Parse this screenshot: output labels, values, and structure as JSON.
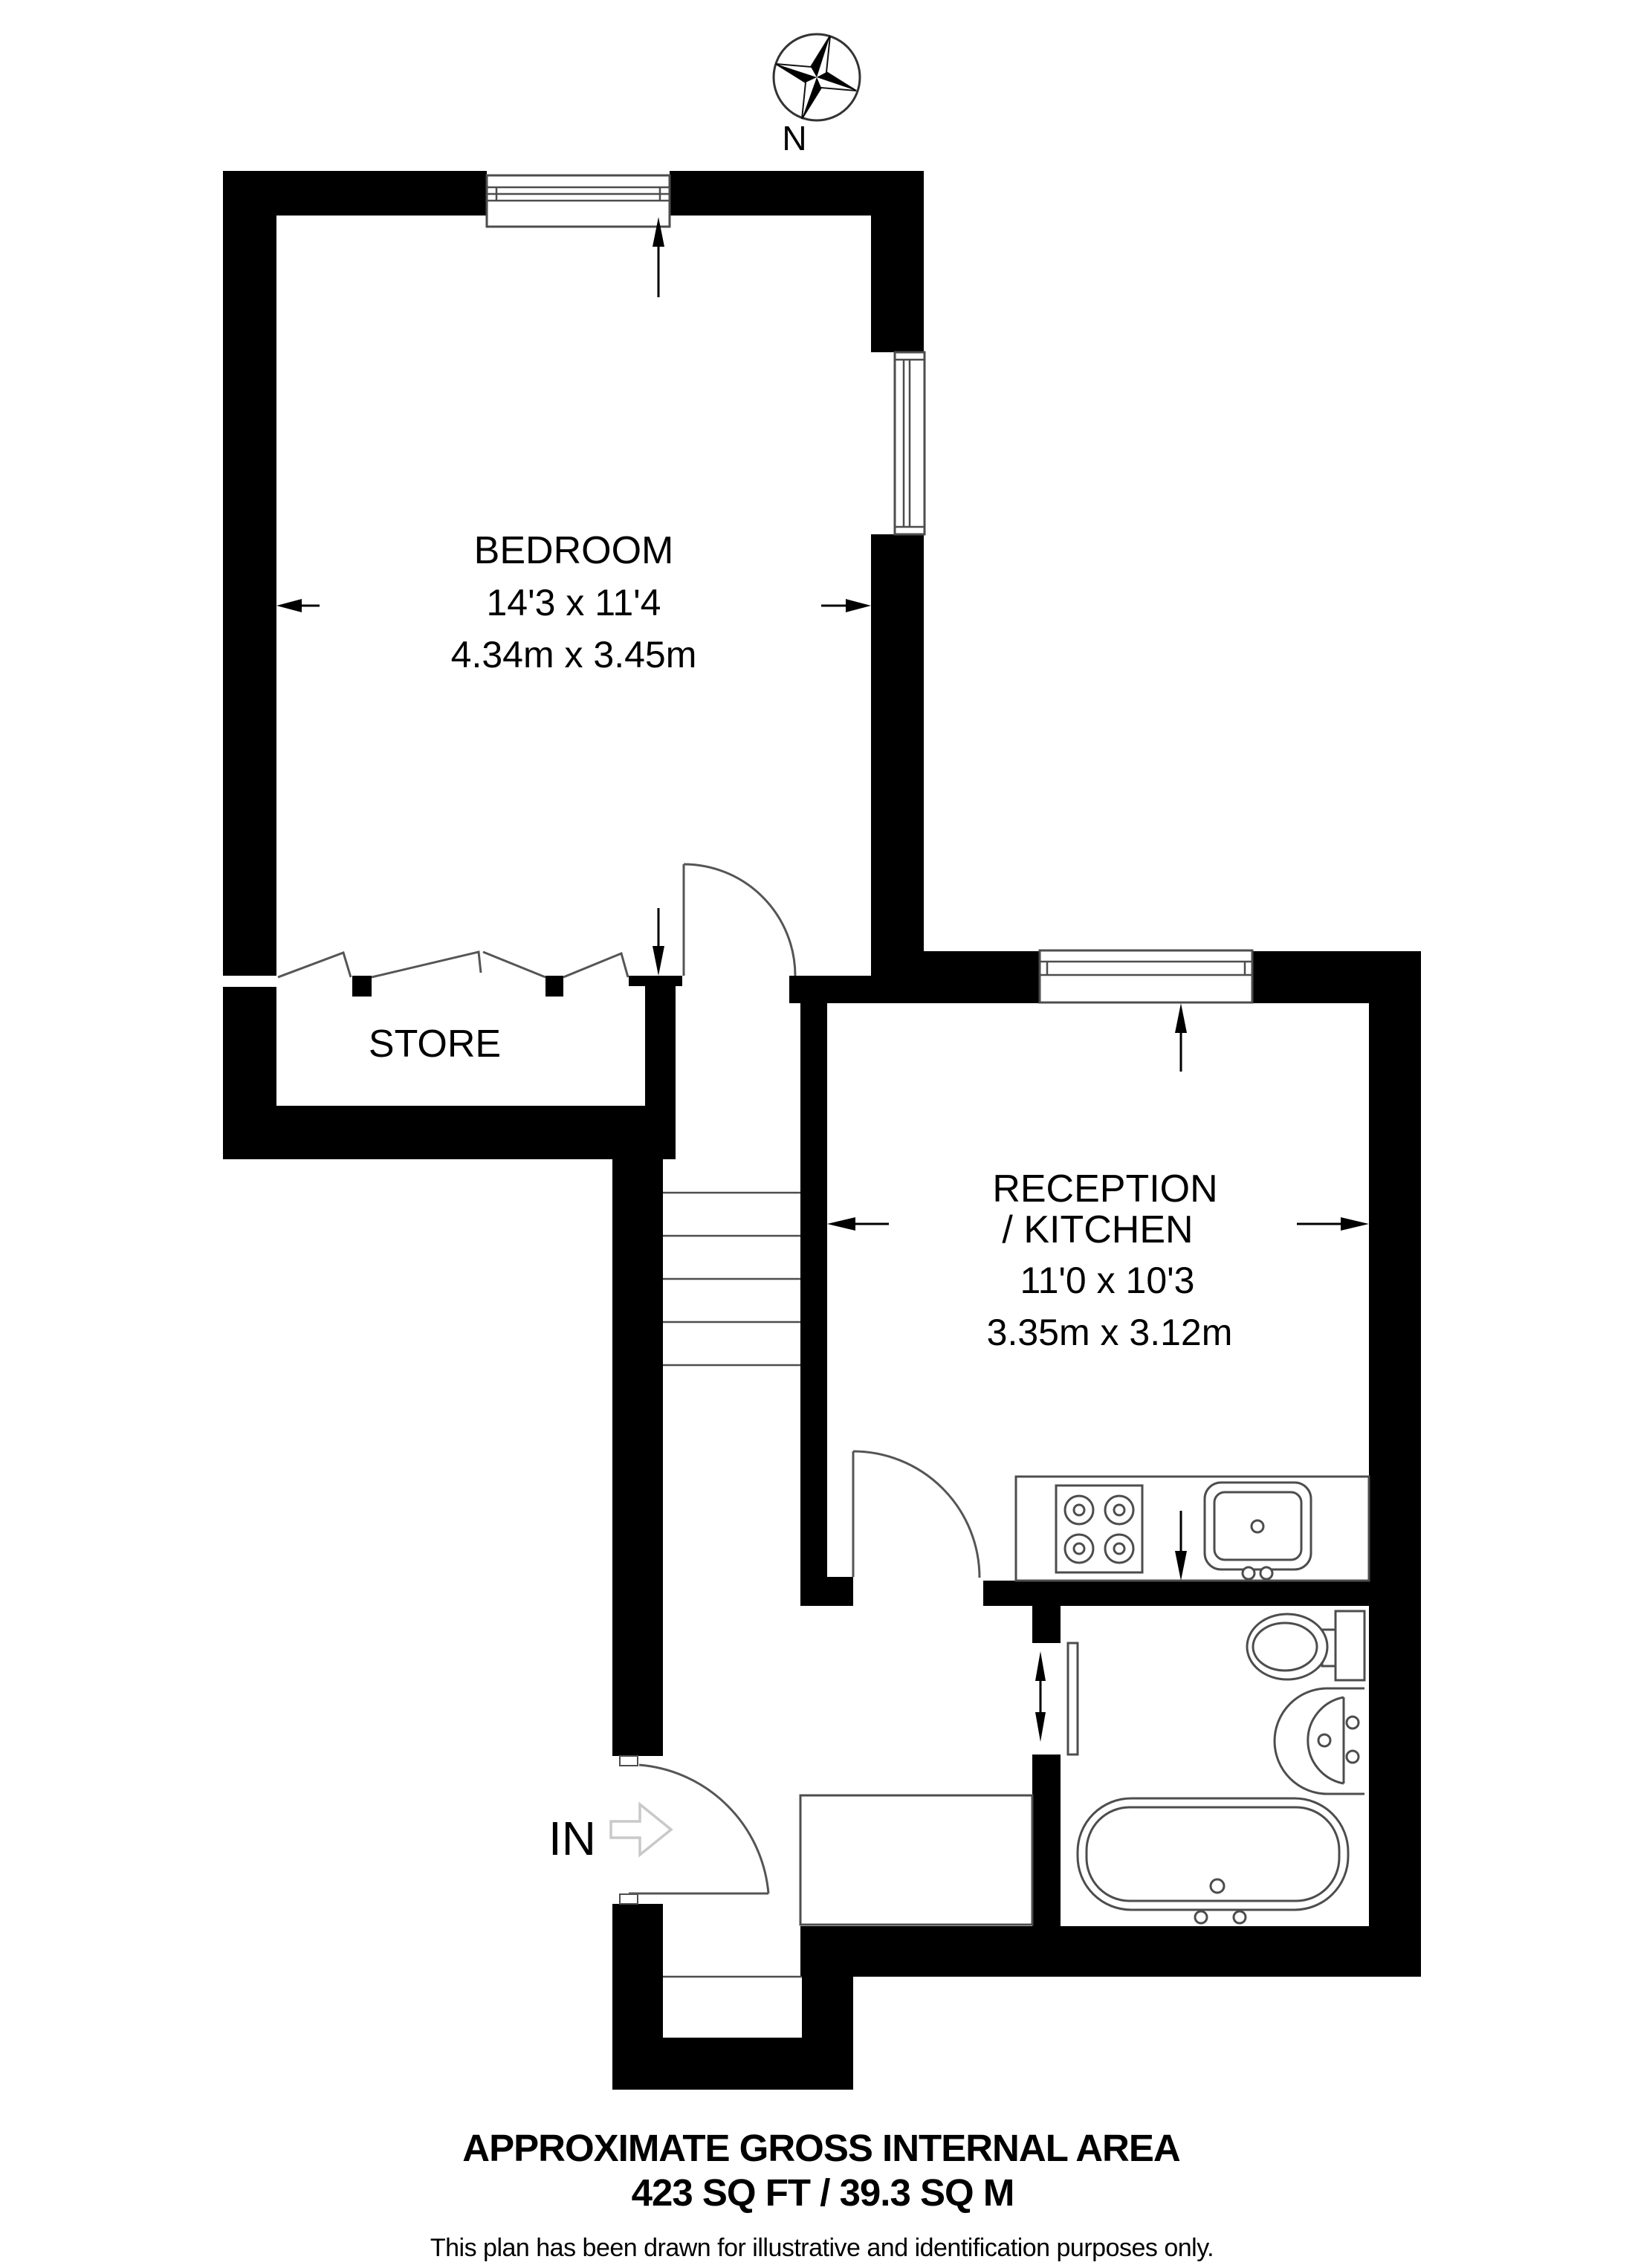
{
  "compass": {
    "north_label": "N"
  },
  "rooms": {
    "bedroom": {
      "name": "BEDROOM",
      "dims_imperial": "14'3 x 11'4",
      "dims_metric": "4.34m x 3.45m"
    },
    "store": {
      "name": "STORE"
    },
    "reception": {
      "name_line1": "RECEPTION",
      "name_line2": "/ KITCHEN",
      "dims_imperial": "11'0 x 10'3",
      "dims_metric": "3.35m x 3.12m"
    }
  },
  "entrance": {
    "label": "IN"
  },
  "footer": {
    "title": "APPROXIMATE GROSS INTERNAL AREA",
    "area": "423 SQ FT / 39.3 SQ M",
    "disclaimer": "This plan has been drawn for illustrative and identification purposes only."
  },
  "colors": {
    "wall": "#000000",
    "fixture_line": "#4d4d4d",
    "door_line": "#555555",
    "entry_arrow": "#c9c9c9"
  }
}
